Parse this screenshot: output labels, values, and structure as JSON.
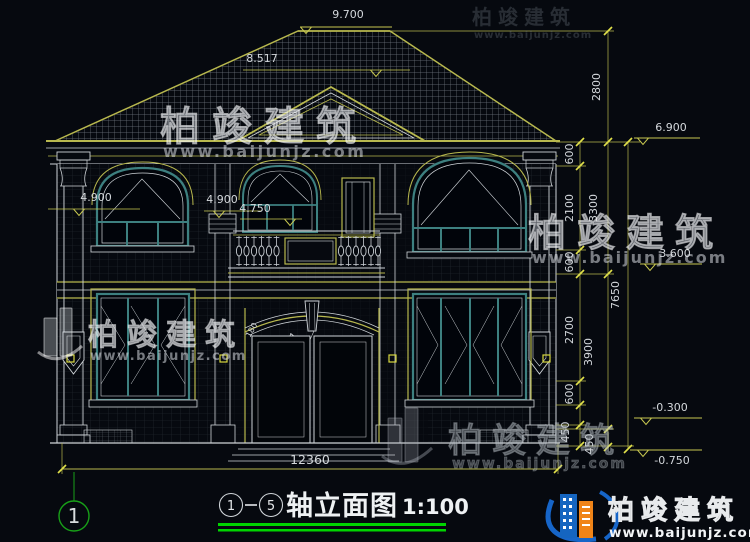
{
  "elevations": {
    "ridge": "9.700",
    "pediment": "8.517",
    "eave": "6.900",
    "left_floor2": "4.900",
    "center_floor2": "4.900",
    "balcony": "4.750",
    "level2": "3.600",
    "ground": "-0.300",
    "footing": "-0.750"
  },
  "dims": {
    "a600_1": "600",
    "a2100": "2100",
    "a600_2": "600",
    "a2700": "2700",
    "a600_3": "600",
    "a450_1": "450",
    "a450_2": "450",
    "b2800": "2800",
    "b3300": "3300",
    "b3900": "3900",
    "c7650": "7650",
    "bottom_total": "12360"
  },
  "door": {
    "radius_label": "R5607",
    "arc_label": "180"
  },
  "axis": {
    "bubble": "1"
  },
  "title_block": {
    "axis_start": "1",
    "axis_end": "5",
    "dash": "—",
    "title": "轴立面图",
    "scale": "1:100"
  },
  "watermark": {
    "brand": "柏竣建筑",
    "url": "www.baijunjz.com"
  },
  "logo": {
    "brand": "柏竣建筑",
    "url": "www.baijunjz.com"
  },
  "colors": {
    "background": "#06090f",
    "cad_yellow": "#b8b84e",
    "cad_white": "#cfd4d8",
    "window_teal": "#3d8080",
    "axis_green": "#18a018",
    "underline_green": "#00d400",
    "logo_blue": "#1565c0",
    "logo_orange": "#f08418"
  }
}
